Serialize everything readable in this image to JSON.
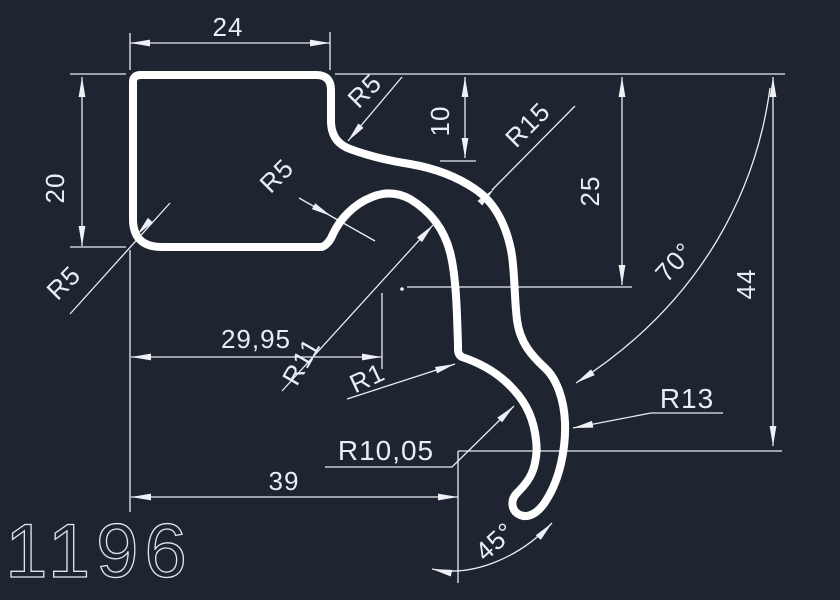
{
  "canvas": {
    "background": "#1e2430",
    "profile_color": "#ffffff",
    "dim_color": "#e9edf4"
  },
  "dims": {
    "width_top": "24",
    "height_left": "20",
    "radius_top_fillet": "R5",
    "offset_top_right": "10",
    "radius_sweep": "R15",
    "height_mid": "25",
    "radius_inner_arch": "R5",
    "radius_corner_bl": "R5",
    "angle_upper": "70°",
    "height_right": "44",
    "width_mid": "29,95",
    "radius_arch_right": "R11",
    "radius_notch": "R1",
    "radius_hook": "R13",
    "radius_bulge": "R10,05",
    "width_bottom": "39",
    "angle_tip": "45°",
    "part_number": "1196"
  }
}
